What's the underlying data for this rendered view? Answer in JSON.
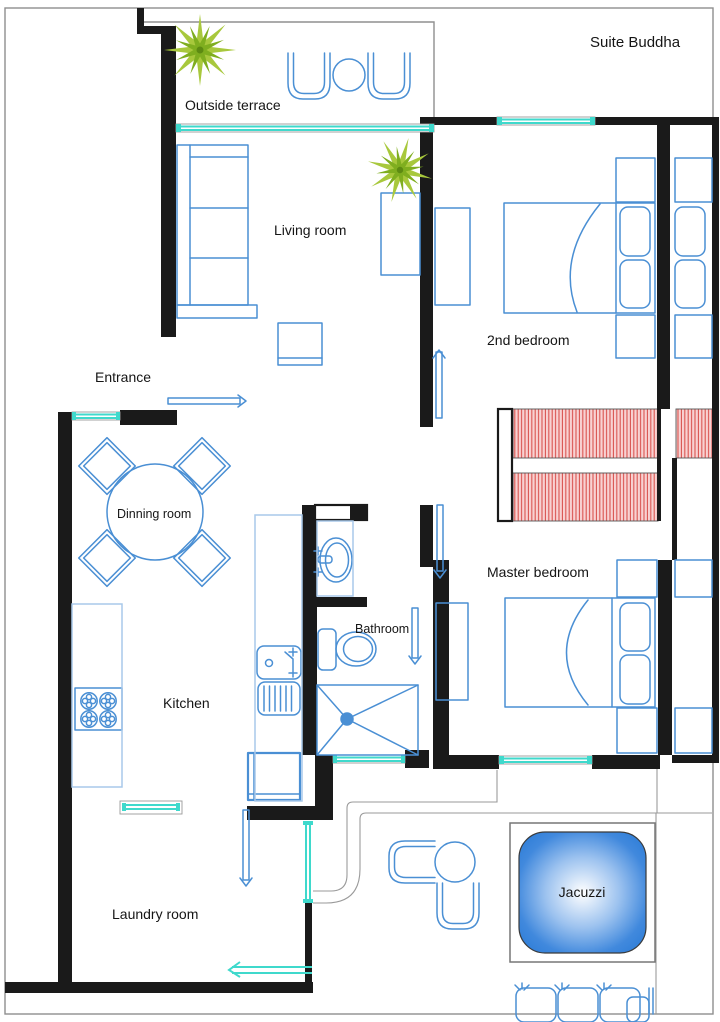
{
  "title": "Suite Buddha",
  "rooms": {
    "terrace": "Outside terrace",
    "living": "Living room",
    "bedroom2": "2nd bedroom",
    "entrance": "Entrance",
    "dining": "Dinning room",
    "master": "Master bedroom",
    "bathroom": "Bathroom",
    "kitchen": "Kitchen",
    "laundry": "Laundry room",
    "jacuzzi": "Jacuzzi"
  },
  "colors": {
    "wall": "#1a1a1a",
    "furniture_blue": "#4a8fd4",
    "furniture_light_blue": "#a9c9ea",
    "window_cyan": "#3fd9cc",
    "closet_red": "#d9534f",
    "plant_green": "#9cbf2e",
    "jacuzzi_blue": "#2f7ed8"
  }
}
